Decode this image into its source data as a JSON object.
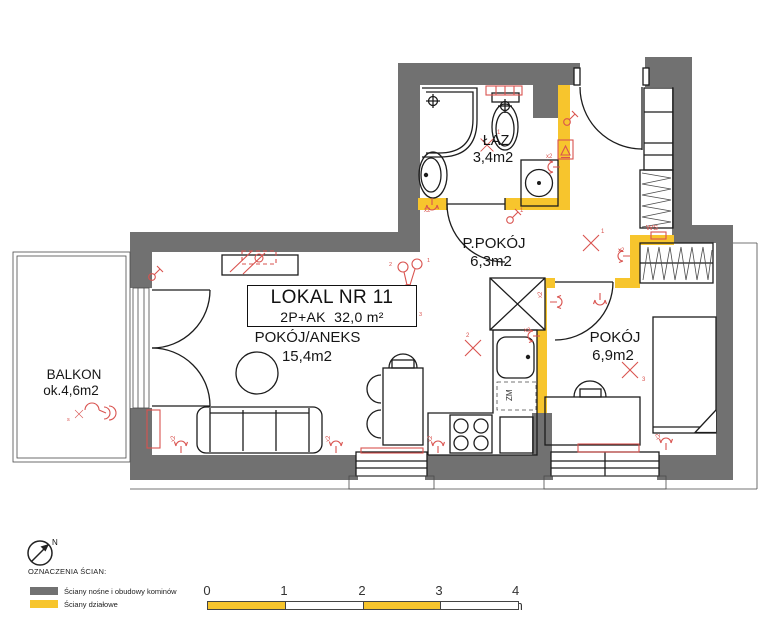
{
  "colors": {
    "bg": "#ffffff",
    "wall_load_bearing": "#717171",
    "wall_partition": "#F7C52D",
    "line": "#1c1c1c",
    "red": "#D9534F"
  },
  "title_block": {
    "line1": "LOKAL NR 11",
    "line2": "2P+AK  32,0 m²"
  },
  "rooms": [
    {
      "name": "BALKON",
      "area": "ok.4,6m2"
    },
    {
      "name": "POKÓJ/ANEKS",
      "area": "15,4m2"
    },
    {
      "name": "P.POKÓJ",
      "area": "6,3m2"
    },
    {
      "name": "ŁAZ",
      "area": "3,4m2"
    },
    {
      "name": "POKÓJ",
      "area": "6,9m2"
    }
  ],
  "annotations": {
    "zm": "ZM",
    "ws": "WS",
    "x2": "x2",
    "s": "s",
    "n1": "1",
    "n2": "2",
    "n3": "3",
    "n4": "4"
  },
  "compass": {
    "label": "N"
  },
  "legend": {
    "heading": "OZNACZENIA ŚCIAN:",
    "items": [
      {
        "label": "Ściany nośne i obudowy kominów",
        "color": "#717171"
      },
      {
        "label": "Ściany działowe",
        "color": "#F7C52D"
      }
    ]
  },
  "scale_bar": {
    "labels": [
      "0",
      "1",
      "2",
      "3"
    ],
    "end_label": "4 m"
  }
}
